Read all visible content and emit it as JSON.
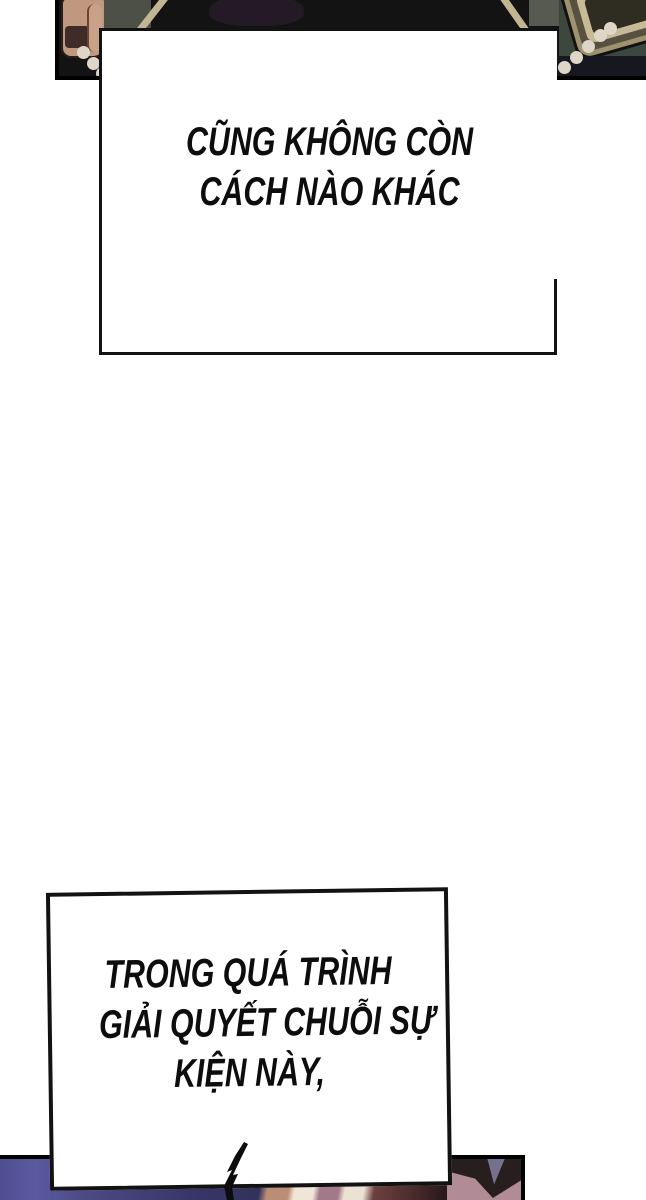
{
  "comic": {
    "bubble1": {
      "lines": [
        "CŨNG KHÔNG CÒN",
        "CÁCH NÀO KHÁC"
      ]
    },
    "bubble2": {
      "lines": [
        "TRONG QUÁ TRÌNH",
        "GIẢI QUYẾT CHUỖI SỰ",
        "KIỆN NÀY,"
      ]
    }
  },
  "colors": {
    "ink": "#121212",
    "panel_black": "#131313",
    "skin": "#c09880",
    "skin_hi": "#c9a188",
    "maroon": "#3f2b28",
    "green_gray": "#4c5046",
    "green_gray2": "#565a50",
    "strap_tan": "#c1b593",
    "purple_blob": "#241a26",
    "moss_green": "#3c473e",
    "khaki_outer": "#9e9270",
    "khaki_mid": "#58513f",
    "khaki_light": "#c6ba97",
    "khaki_core": "#2f2c22",
    "bead": "#ddd6c9",
    "navy": "#171720",
    "blue_left": "#514f92",
    "blue_hi": "#5b59a0",
    "blue_mid": "#4a4880",
    "blue_deep": "#373567",
    "blue_deep2": "#32325a",
    "stripe_tan": "#bb8d74",
    "stripe_cream": "#f0e6d8",
    "stripe_mauve": "#a3798a",
    "stripe_cream2": "#ece2d4",
    "stripe_maroon": "#6e4040",
    "stripe_maroon2": "#4a2b2b",
    "cap_mauve": "#b18c96",
    "cap_dark": "#261f1e",
    "cap_triangle": "#76718e"
  }
}
